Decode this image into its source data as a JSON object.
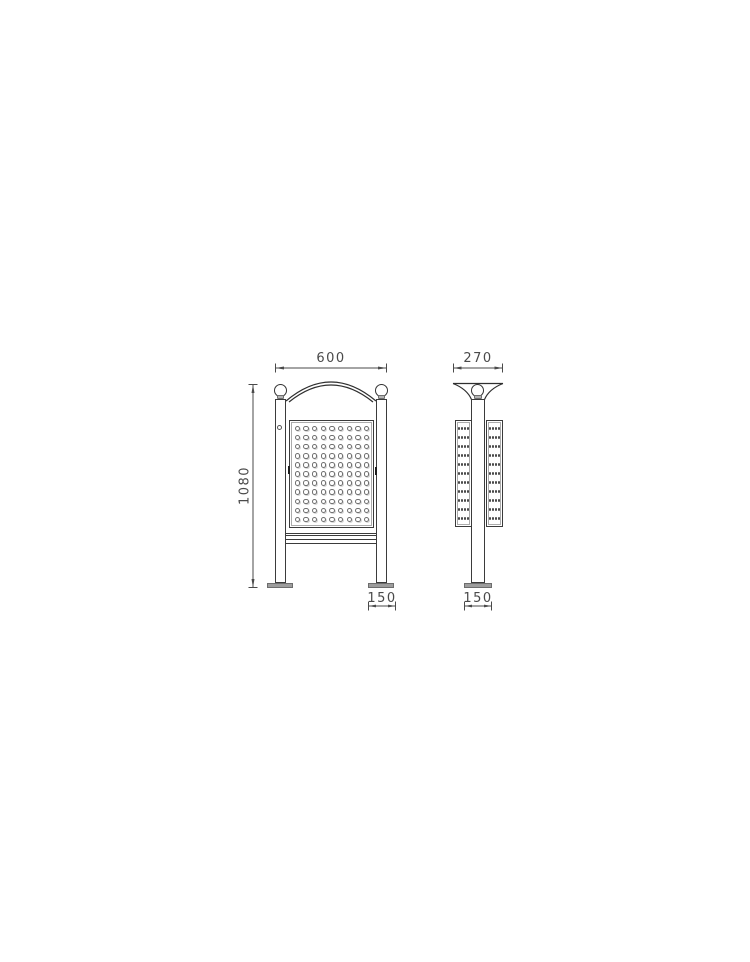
{
  "canvas": {
    "background": "#ffffff",
    "line_color": "#3b3b3b",
    "dimension_color": "#4a4a4a",
    "metal_fill": "#9d9d9d"
  },
  "front_view": {
    "width_dim": "600",
    "height_dim": "1080",
    "foot_dim": "150",
    "panel_dots": {
      "cols": 9,
      "rows": 11
    }
  },
  "side_view": {
    "depth_dim": "270",
    "foot_dim": "150",
    "left_panel_dots": {
      "cols": 4,
      "rows": 11
    },
    "right_panel_dots": {
      "cols": 4,
      "rows": 11
    }
  }
}
